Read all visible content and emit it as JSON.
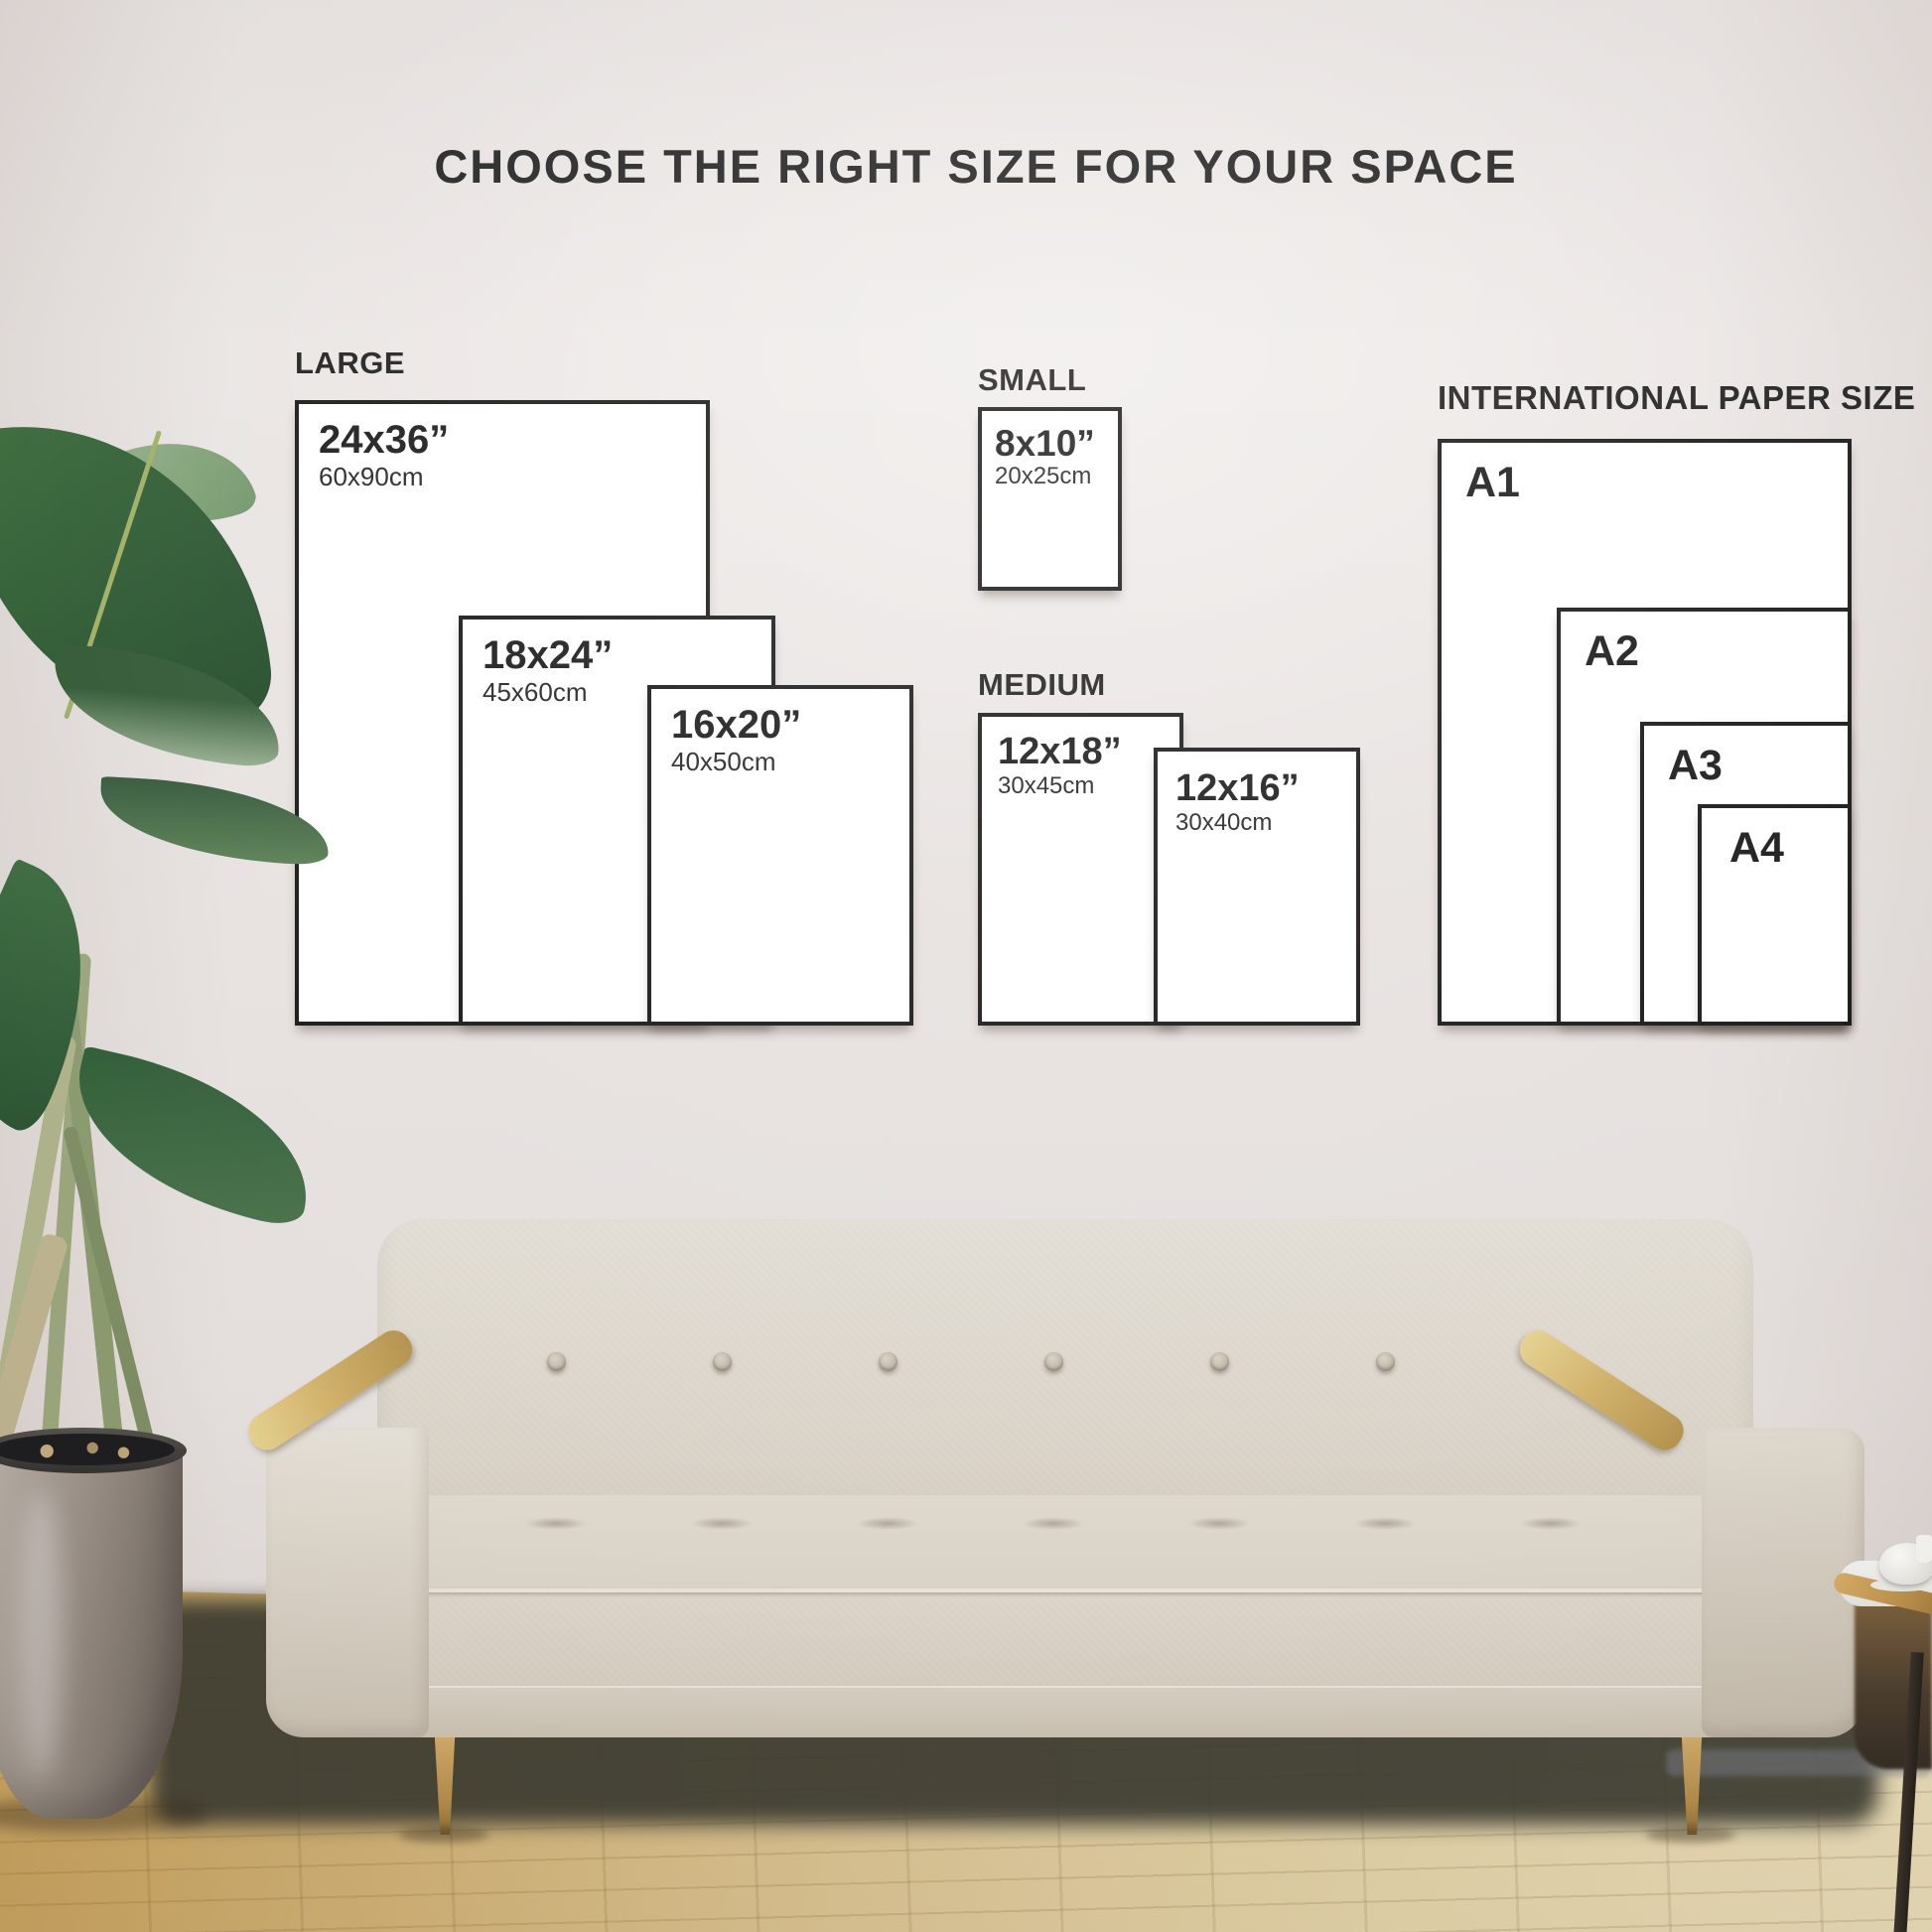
{
  "title": "CHOOSE THE RIGHT SIZE FOR YOUR SPACE",
  "groups": [
    {
      "label": "LARGE",
      "sizes": [
        {
          "inches": "24x36”",
          "cm": "60x90cm"
        },
        {
          "inches": "18x24”",
          "cm": "45x60cm"
        },
        {
          "inches": "16x20”",
          "cm": "40x50cm"
        }
      ]
    },
    {
      "label": "SMALL",
      "sizes": [
        {
          "inches": "8x10”",
          "cm": "20x25cm"
        }
      ]
    },
    {
      "label": "MEDIUM",
      "sizes": [
        {
          "inches": "12x18”",
          "cm": "30x45cm"
        },
        {
          "inches": "12x16”",
          "cm": "30x40cm"
        }
      ]
    },
    {
      "label": "INTERNATIONAL PAPER SIZE",
      "sizes": [
        {
          "name": "A1"
        },
        {
          "name": "A2"
        },
        {
          "name": "A3"
        },
        {
          "name": "A4"
        }
      ]
    }
  ],
  "scene": {
    "description_colors_only": "photo backdrop: wall, wood floor, cream sofa, plant in pot, side table",
    "colors": {
      "wall": "#eae5e3",
      "paper": "#ffffff",
      "line": "#161616",
      "text": "#1b1b1b",
      "floor_dark": "#c49e58",
      "floor_light": "#e6d9b4",
      "couch": "#ddd7cc",
      "couch_dark": "#cdc4b6",
      "wood": "#caa85e",
      "leaf": "#2f5c36",
      "leaf_light": "#93ac8c",
      "pot": "#978d84"
    }
  }
}
